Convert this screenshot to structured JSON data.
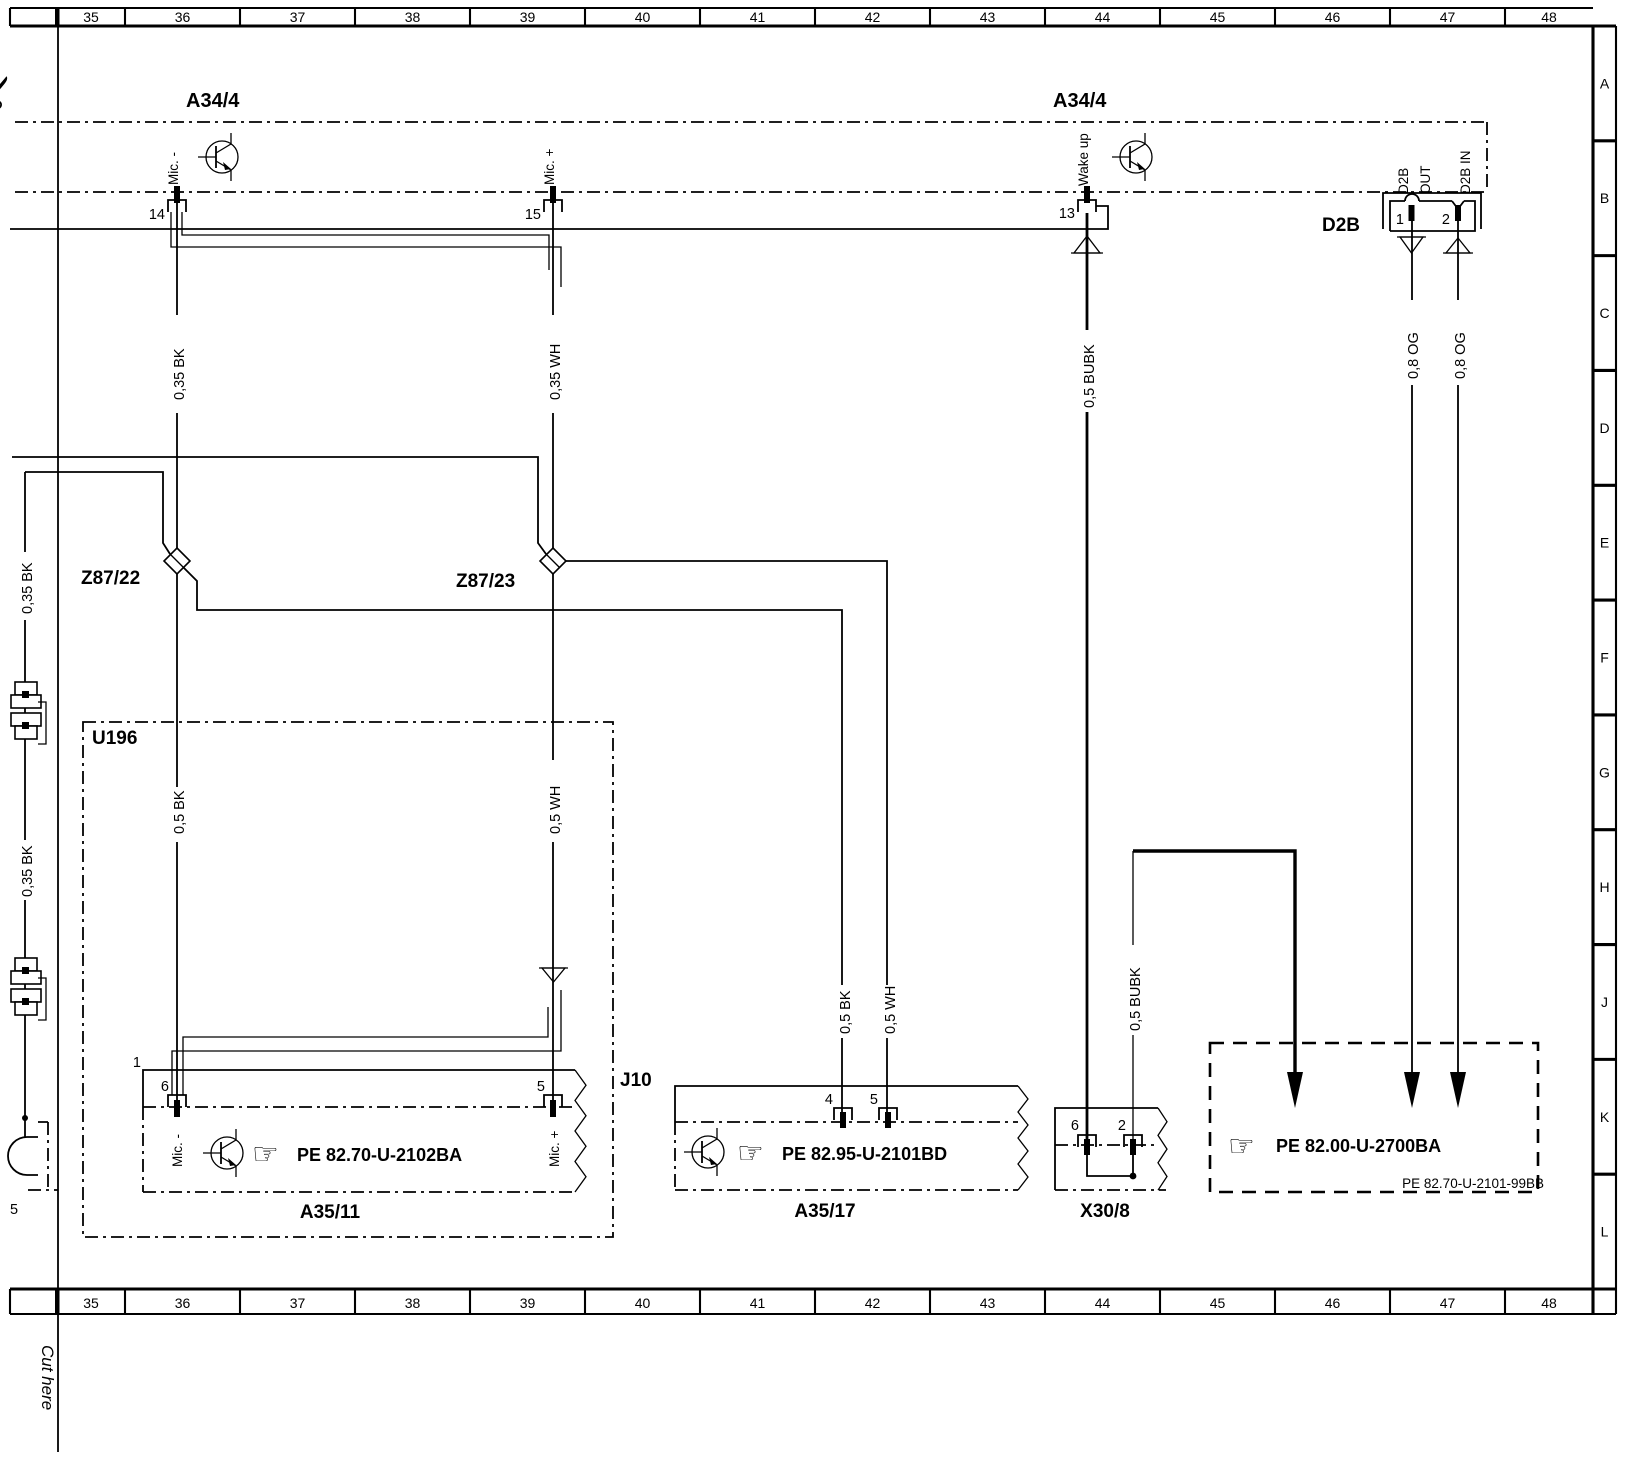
{
  "colors": {
    "ink": "#000000",
    "paper": "#ffffff"
  },
  "icons": {
    "scissors": "✂",
    "hand": "☞"
  },
  "rulers": {
    "top": [
      "35",
      "36",
      "37",
      "38",
      "39",
      "40",
      "41",
      "42",
      "43",
      "44",
      "45",
      "46",
      "47",
      "48"
    ],
    "bottom": [
      "35",
      "36",
      "37",
      "38",
      "39",
      "40",
      "41",
      "42",
      "43",
      "44",
      "45",
      "46",
      "47",
      "48"
    ],
    "right": [
      "A",
      "B",
      "C",
      "D",
      "E",
      "F",
      "G",
      "H",
      "J",
      "K",
      "L"
    ]
  },
  "labels": {
    "a34_left": "A34/4",
    "a34_right": "A34/4",
    "d2b": "D2B",
    "z87_22": "Z87/22",
    "z87_23": "Z87/23",
    "u196": "U196",
    "j10": "J10",
    "a35_11": "A35/11",
    "a35_17": "A35/17",
    "x30_8": "X30/8",
    "pe_a35_11": "PE 82.70-U-2102BA",
    "pe_a35_17": "PE 82.95-U-2101BD",
    "pe_ref_box": "PE 82.00-U-2700BA",
    "corner_ref": "PE 82.70-U-2101-99BB",
    "cut_here": "Cut here"
  },
  "pins": {
    "a34_14": "14",
    "a34_15": "15",
    "a34_13": "13",
    "d2b_1": "1",
    "d2b_2": "2",
    "a3511_conn": "1",
    "a3511_6": "6",
    "a3511_5": "5",
    "a3517_4": "4",
    "a3517_5": "5",
    "x308_6": "6",
    "x308_2": "2",
    "left_5": "5"
  },
  "pin_functions": {
    "mic_minus": "Mic. -",
    "mic_plus": "Mic. +",
    "wake_up": "Wake up",
    "d2b_out_1": "D2B",
    "d2b_out_2": "OUT",
    "d2b_in": "D2B IN",
    "a3511_mic_minus": "Mic. -",
    "a3511_mic_plus": "Mic. +"
  },
  "wires": {
    "bk035_top": "0,35 BK",
    "wh035_top": "0,35 WH",
    "bubk05_top": "0,5 BUBK",
    "og08_out": "0,8 OG",
    "og08_in": "0,8 OG",
    "bk035_left_upper": "0,35 BK",
    "bk035_left_lower": "0,35 BK",
    "bk05_u196": "0,5 BK",
    "wh05_u196": "0,5 WH",
    "bk05_a3517": "0,5 BK",
    "wh05_a3517": "0,5 WH",
    "bubk05_x308": "0,5 BUBK"
  }
}
